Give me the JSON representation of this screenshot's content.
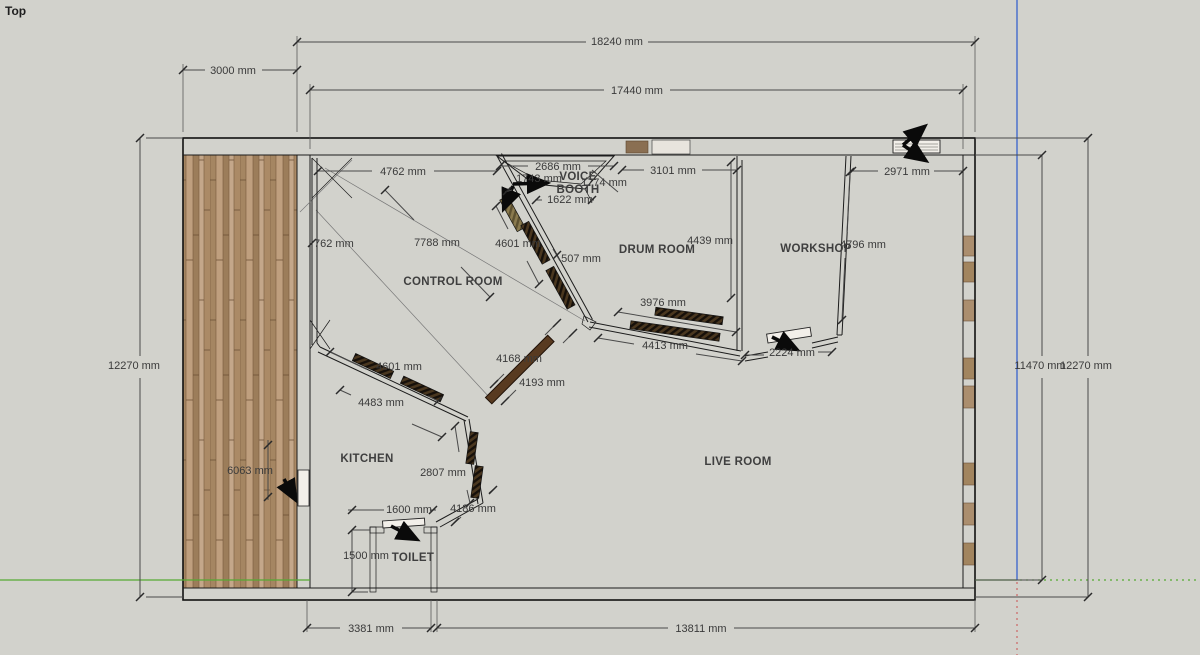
{
  "view": {
    "label": "Top"
  },
  "colors": {
    "background": "#d2d2cc",
    "wall_fill": "#bda189",
    "wood_light": "#c4a78a",
    "wood_dark": "#9c7d5a",
    "door_bar": "#583a20",
    "axis_green": "#55aa33",
    "axis_blue": "#5577cc",
    "axis_red": "#cc6666",
    "dim_text": "#3a3a3a"
  },
  "rooms": {
    "control": "CONTROL ROOM",
    "voice_line1": "VOICE",
    "voice_line2": "BOOTH",
    "drum": "DRUM ROOM",
    "workshop": "WORKSHOP",
    "kitchen": "KITCHEN",
    "live": "LIVE ROOM",
    "toilet": "TOILET"
  },
  "dims": {
    "top_total": "18240 mm",
    "porch_width": "3000 mm",
    "top_inner": "17440 mm",
    "cr_top": "4762 mm",
    "booth_top": "2686 mm",
    "booth_inner": "1743 mm",
    "booth_right": "1774 mm",
    "booth_bottom": "1622 mm",
    "drum_top": "3101 mm",
    "ws_door": "2971 mm",
    "cr_left": "762 mm",
    "cr_diag": "7788 mm",
    "cr_wall": "4601 mm",
    "drum_right": "4439 mm",
    "ws_wall": "4796 mm",
    "small_507": "507 mm",
    "drum_bottom_in": "3976 mm",
    "drum_bottom_out": "4413 mm",
    "live_top": "2224 mm",
    "left_height": "12270 mm",
    "right_inner": "11470 mm",
    "right_height": "12270 mm",
    "kitchen_wall_top": "4601 mm",
    "bar_top": "4168 mm",
    "bar_bottom": "4193 mm",
    "kitchen_wall_bottom": "4483 mm",
    "deck_length": "6063 mm",
    "vestibule": "2807 mm",
    "toilet_door": "1600 mm",
    "vestibule2": "4186 mm",
    "toilet_height": "1500 mm",
    "bottom_left": "3381 mm",
    "bottom_right": "13811 mm"
  }
}
